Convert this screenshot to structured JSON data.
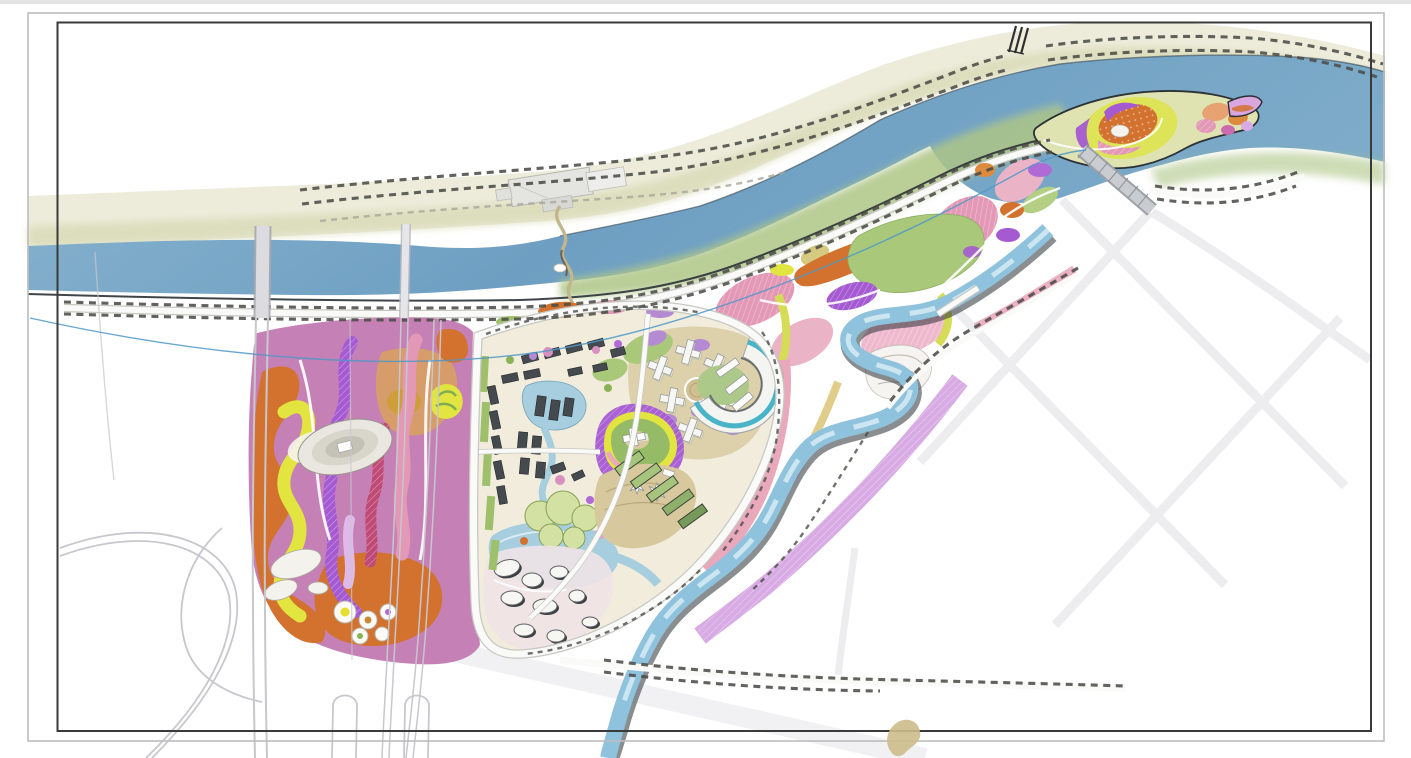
{
  "document": {
    "kind": "riverfront-landscape-master-plan-drawing"
  },
  "palette": {
    "page-bg": "#ffffff",
    "frame-inner": "#3a3a3a",
    "frame-outer": "#bcbcbc",
    "river": "#74a7c8",
    "river-light": "#9bc2da",
    "canal": "#8fc2dc",
    "canal-light": "#d6ecf5",
    "pond-blue": "#a6cede",
    "bank-north": "#ecebd9",
    "bank-olive": "#d8dab6",
    "bank-green": "#aec687",
    "levee-line": "#2c3136",
    "road-white": "#fafaf8",
    "road-edge": "#c8c8c2",
    "grid-road": "#ededf0",
    "tree-dash": "#4c4c48",
    "tree-dash-light": "#a8a69a",
    "park-pink": "#c581b5",
    "band-orange": "#d2722e",
    "band-yellow": "#e2e440",
    "band-purple": "#a55ad2",
    "band-crimson": "#c04a76",
    "band-rose": "#e398b6",
    "band-violet": "#d8abe4",
    "band-ochre": "#d9a258",
    "lawn-green": "#a9c87a",
    "canopy-green": "#d3e2a3",
    "hill-green": "#95bb66",
    "plaza-beige": "#d8c89e",
    "campus-beige": "#dcd1ab",
    "building-dark": "#454a4f",
    "building-white": "#f6f6f3",
    "crescent-teal": "#49b4c8",
    "slab-green": "#a6c47c",
    "blob-shadow": "#3c4043",
    "blue-guide": "#4f98c8",
    "tan-path": "#c3b68d",
    "sand-tan": "#e0cd8a"
  },
  "features": [
    {
      "name": "drawing-frame",
      "note": "double border sheet frame"
    },
    {
      "name": "river",
      "color": "river"
    },
    {
      "name": "river-island-gardens",
      "color": "band-orange"
    },
    {
      "name": "north-bank-promenade",
      "color": "bank-north"
    },
    {
      "name": "station-building-complex",
      "color": "building-white"
    },
    {
      "name": "pedestrian-river-crossing-path",
      "color": "tan-path"
    },
    {
      "name": "west-pink-park",
      "color": "park-pink"
    },
    {
      "name": "amphitheater",
      "color": "building-white"
    },
    {
      "name": "central-development-site",
      "color": "campus-beige"
    },
    {
      "name": "housing-cluster",
      "color": "building-dark"
    },
    {
      "name": "campus-cross-buildings",
      "color": "building-white"
    },
    {
      "name": "crescent-building",
      "color": "crescent-teal"
    },
    {
      "name": "central-hill-garden",
      "color": "hill-green"
    },
    {
      "name": "ponds-and-canopy-garden",
      "color": "pond-blue"
    },
    {
      "name": "meandering-canal",
      "color": "canal"
    },
    {
      "name": "riverside-flower-park",
      "color": "band-rose"
    },
    {
      "name": "east-road-grid",
      "color": "grid-road"
    },
    {
      "name": "highway-interchange",
      "color": "road-edge"
    },
    {
      "name": "street-tree-rows",
      "color": "tree-dash"
    },
    {
      "name": "bridges",
      "color": "road-edge"
    },
    {
      "name": "guide-line",
      "color": "blue-guide"
    }
  ]
}
